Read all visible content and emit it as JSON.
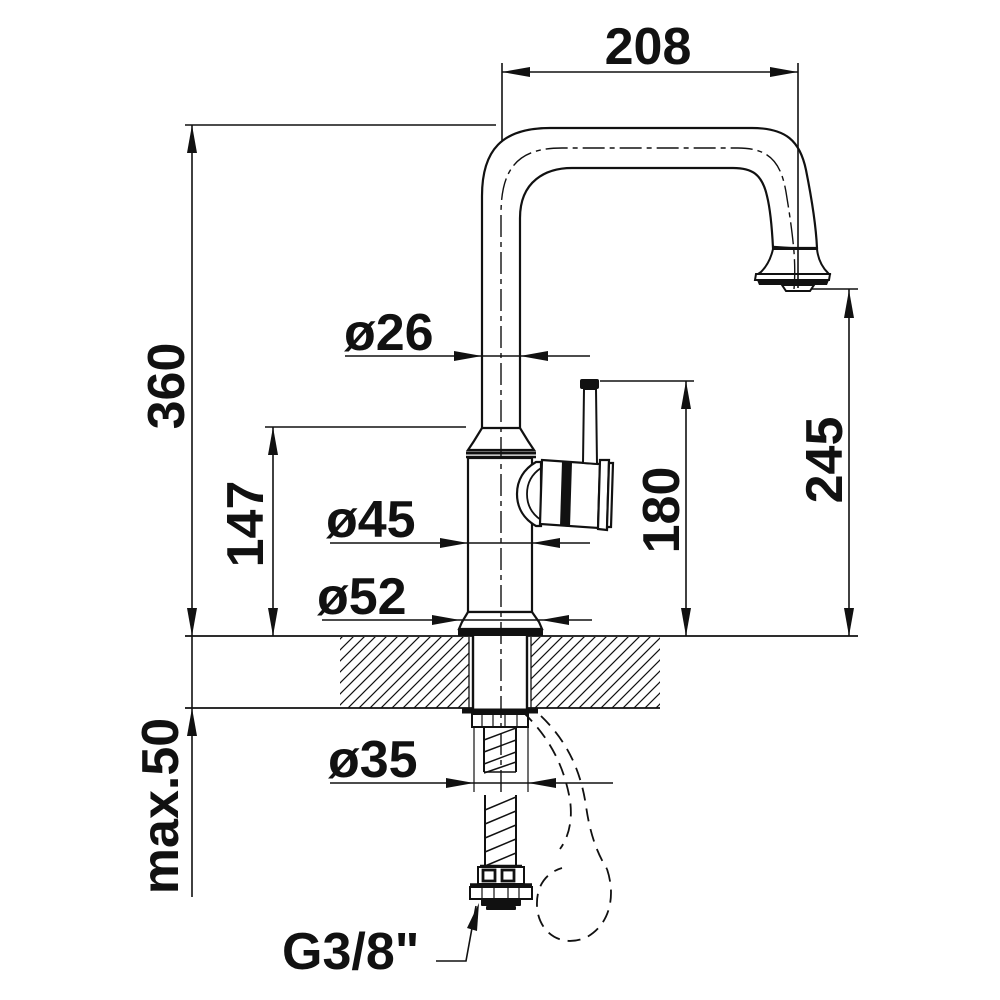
{
  "drawing": {
    "dimensions": {
      "spout_reach": "208",
      "overall_height": "360",
      "spout_tube_diameter": "ø26",
      "height_to_body_top": "147",
      "body_diameter": "ø45",
      "base_diameter": "ø52",
      "height_to_lever_top": "180",
      "height_to_outlet": "245",
      "max_counter_thickness": "max.50",
      "mounting_hole_diameter": "ø35",
      "supply_connection_thread": "G3/8\""
    }
  }
}
